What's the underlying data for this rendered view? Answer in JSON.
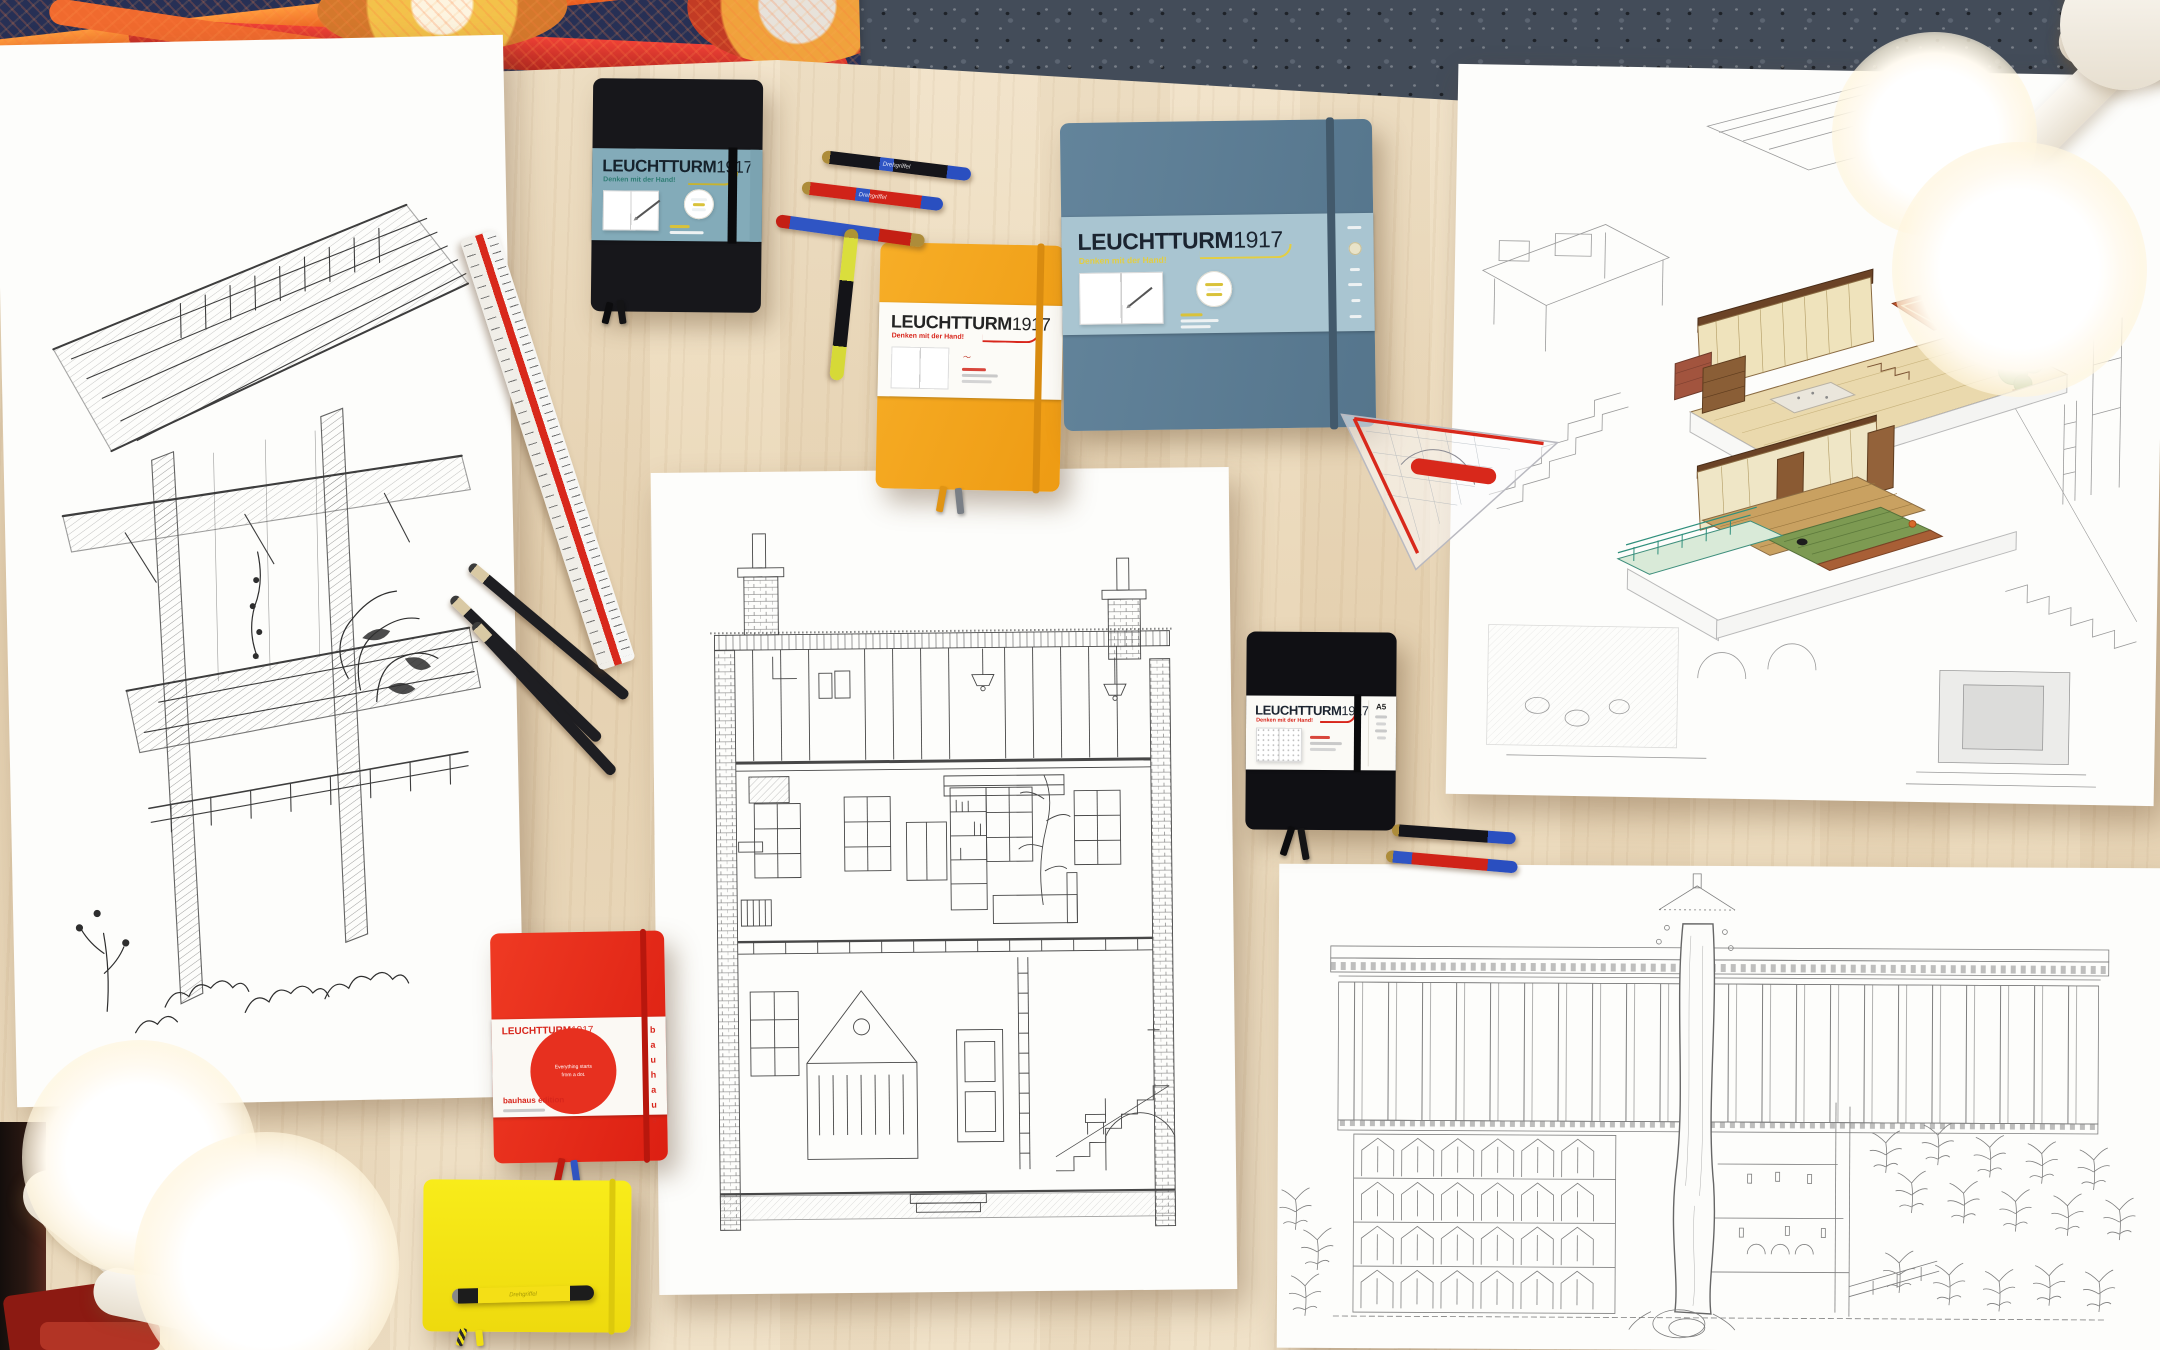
{
  "scene": {
    "description": "Flat-lay photo of an architect's wooden desk with LEUCHTTURM1917 notebooks, pens, rulers and hand-drawn architectural illustrations",
    "floor_material": "dark terrazzo",
    "desk_material": "light maple wood"
  },
  "brand": {
    "logo_main": "LEUCHTTURM",
    "logo_year": "1917",
    "tagline": "Denken mit der Hand!"
  },
  "notebooks": {
    "black_top": {
      "name": "black notebook",
      "cover_color": "#17171b",
      "band_color": "#83abb9",
      "tagline_color": "#2f7d74"
    },
    "orange": {
      "name": "orange composition notebook",
      "cover_color": "#f3a51f",
      "band_color": "#ffffff",
      "tagline_color": "#d8261c"
    },
    "slate": {
      "name": "slate blue square sketchbook",
      "cover_color": "#5d7e94",
      "band_color": "#a9c5d1",
      "tagline_color": "#e3ce42"
    },
    "black_small": {
      "name": "black dotted notebook",
      "cover_color": "#0f0f12",
      "band_color": "#ffffff",
      "tagline_color": "#d8261c",
      "size_label": "A5"
    },
    "red": {
      "name": "red bauhaus edition notebook",
      "cover_color": "#e7301f",
      "band_color": "#ffffff",
      "edition_label": "bauhaus edition",
      "vertical_label": "bauhaus",
      "circle_line1": "Everything starts",
      "circle_line2": "from a dot."
    },
    "yellow": {
      "name": "yellow landscape notebook",
      "cover_color": "#f6e312"
    }
  },
  "pens": {
    "model_label": "Drehgriffel",
    "colors": {
      "black": "#17171b",
      "red": "#d02318",
      "blue": "#2f55c4",
      "yellow": "#f0e024",
      "gold_tip": "#ab8c3a"
    }
  },
  "tools": {
    "scale_ruler": {
      "name": "triangular scale ruler",
      "stripe_color": "#d8281b"
    },
    "set_square": {
      "name": "geometry set square",
      "accent_color": "#d8281b"
    },
    "pencils": {
      "name": "drawing pencils",
      "count": 3
    }
  },
  "drawings": {
    "left": {
      "name": "ink perspective sketch of a plant-filled atrium"
    },
    "center": {
      "name": "ink cross-section drawing of a townhouse"
    },
    "right": {
      "name": "isometric cutaway drawing of a japanese house, partly colored"
    },
    "bottom_right": {
      "name": "ink section drawing of a tree tower beside a forest"
    }
  },
  "lighting": {
    "name": "glowing studio bulbs"
  }
}
